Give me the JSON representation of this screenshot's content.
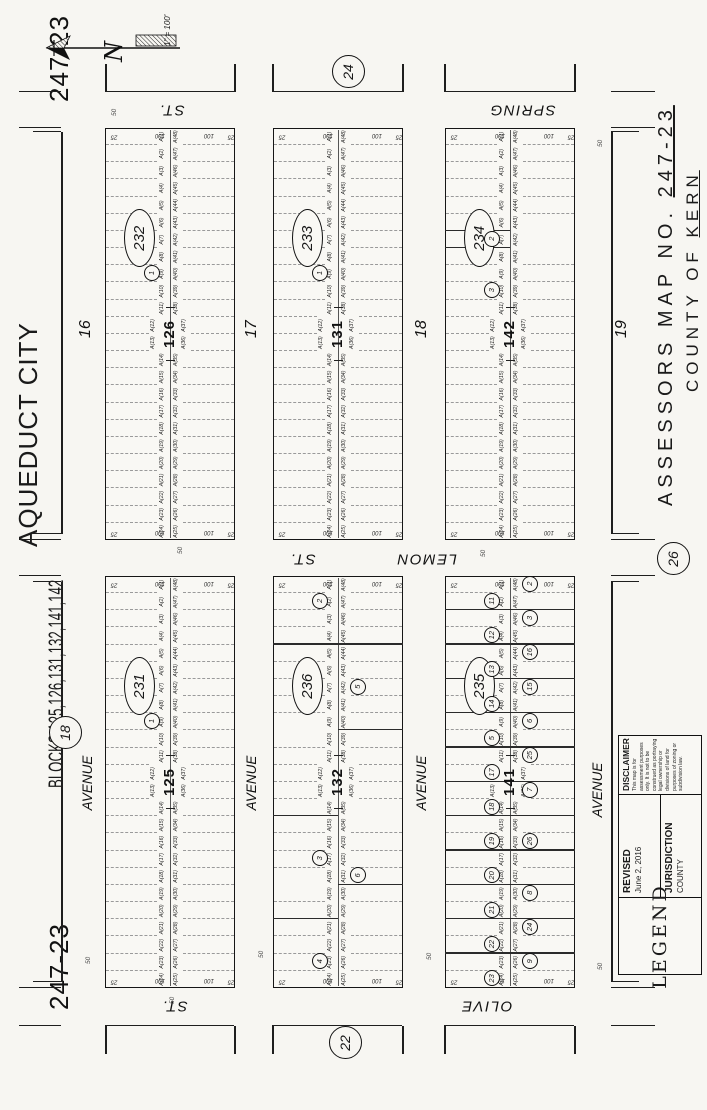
{
  "page": {
    "sheet_no": "247-23",
    "title_line1": "AQUEDUCT CITY",
    "title_line2": "BLOCKS 125,126,131,132,141,142",
    "assessors_prefix": "ASSESSORS MAP NO.",
    "assessors_no": "247-23",
    "county_prefix": "COUNTY OF",
    "county_name": "KERN",
    "scale_label": "1\" = 100'",
    "north_label": "N"
  },
  "legend": {
    "legend_word": "LEGEND",
    "revised_label": "REVISED",
    "revised_date": "June 2, 2016",
    "jurisdiction_label": "JURISDICTION",
    "jurisdiction_value": "COUNTY",
    "disclaimer_label": "DISCLAIMER",
    "disclaimer_text": "This map is for assessment purposes only. It is not to be construed as portraying legal ownership or divisions of land for purposes of zoning or subdivision law."
  },
  "adjacent_sheets": [
    {
      "label": "24",
      "x": 1037,
      "y": 347
    },
    {
      "label": "18",
      "x": 376,
      "y": 64
    },
    {
      "label": "26",
      "x": 550,
      "y": 672
    },
    {
      "label": "22",
      "x": 66,
      "y": 344
    }
  ],
  "streets": {
    "avenue_label": "AVENUE",
    "avenues": [
      {
        "number": "16",
        "label_x": 327,
        "label_y": 88,
        "num_x": 772,
        "num_y": 86
      },
      {
        "number": "17",
        "label_x": 327,
        "label_y": 252,
        "num_x": 772,
        "num_y": 252
      },
      {
        "number": "18",
        "label_x": 327,
        "label_y": 422,
        "num_x": 772,
        "num_y": 422
      },
      {
        "number": "19",
        "label_x": 320,
        "label_y": 598,
        "num_x": 772,
        "num_y": 622
      }
    ],
    "cross_streets": [
      {
        "name": "OLIVE",
        "suffix": "ST.",
        "x": 104,
        "name_y": 487,
        "suffix_y": 175
      },
      {
        "name": "LEMON",
        "suffix": "ST.",
        "x": 551,
        "name_y": 427,
        "suffix_y": 303
      },
      {
        "name": "SPRING",
        "suffix": "ST.",
        "x": 1000,
        "name_y": 523,
        "suffix_y": 172
      }
    ],
    "width_labels": [
      {
        "t": "50",
        "x": 994,
        "y": 112
      },
      {
        "t": "50",
        "x": 556,
        "y": 178
      },
      {
        "t": "50",
        "x": 553,
        "y": 481
      },
      {
        "t": "50",
        "x": 106,
        "y": 170
      },
      {
        "t": "50",
        "x": 146,
        "y": 86
      },
      {
        "t": "50",
        "x": 152,
        "y": 259
      },
      {
        "t": "50",
        "x": 150,
        "y": 427
      },
      {
        "t": "50",
        "x": 140,
        "y": 598
      },
      {
        "t": "50",
        "x": 963,
        "y": 598
      }
    ]
  },
  "lots": [
    "A(1)",
    "A(2)",
    "A(3)",
    "A(4)",
    "A(5)",
    "A(6)",
    "A(7)",
    "A(8)",
    "A(9)",
    "A(10)",
    "A(11)",
    "A(12)",
    "A(13)",
    "A(14)",
    "A(15)",
    "A(16)",
    "A(17)",
    "A(18)",
    "A(19)",
    "A(20)",
    "A(21)",
    "A(22)",
    "A(23)",
    "A(24)",
    "A(25)",
    "A(26)",
    "A(27)",
    "A(28)",
    "A(29)",
    "A(30)",
    "A(31)",
    "A(32)",
    "A(33)",
    "A(34)",
    "A(35)",
    "A(36)",
    "A(37)",
    "A(38)",
    "A(39)",
    "A(40)",
    "A(41)",
    "A(42)",
    "A(43)",
    "A(44)",
    "A(45)",
    "A(46)",
    "A(47)",
    "A(48)"
  ],
  "edge_dims": [
    "25",
    "100",
    "100",
    "25"
  ],
  "blocks": [
    {
      "id": "232",
      "number": "126",
      "x": 570,
      "y": 105,
      "parcels": [
        {
          "n": "1",
          "c": 9,
          "half": "top"
        }
      ],
      "solids": []
    },
    {
      "id": "233",
      "number": "131",
      "x": 570,
      "y": 273,
      "parcels": [
        {
          "n": "1",
          "c": 9,
          "half": "top"
        }
      ],
      "solids": []
    },
    {
      "id": "234",
      "number": "142",
      "x": 570,
      "y": 445,
      "parcels": [
        {
          "n": "2",
          "c": 7,
          "half": "top"
        },
        {
          "n": "3",
          "c": 10,
          "half": "top"
        }
      ],
      "solids": [
        {
          "b": 6,
          "half": "top"
        },
        {
          "b": 7,
          "half": "top"
        }
      ]
    },
    {
      "id": "231",
      "number": "125",
      "x": 122,
      "y": 105,
      "parcels": [
        {
          "n": "1",
          "c": 9,
          "half": "top"
        }
      ],
      "solids": []
    },
    {
      "id": "236",
      "number": "132",
      "x": 122,
      "y": 273,
      "parcels": [
        {
          "n": "2",
          "c": 2,
          "half": "top"
        },
        {
          "n": "3",
          "c": 17,
          "half": "top"
        },
        {
          "n": "4",
          "c": 23,
          "half": "top"
        },
        {
          "n": "5",
          "c": 7,
          "half": "bottom"
        },
        {
          "n": "6",
          "c": 18,
          "half": "bottom"
        }
      ],
      "solids": [
        {
          "b": 4,
          "half": "full"
        },
        {
          "b": 9,
          "half": "bottom"
        },
        {
          "b": 14,
          "half": "top"
        },
        {
          "b": 18,
          "half": "bottom"
        },
        {
          "b": 20,
          "half": "top"
        }
      ]
    },
    {
      "id": "235",
      "number": "141",
      "x": 122,
      "y": 445,
      "parcels": [
        {
          "n": "11",
          "c": 2,
          "half": "top"
        },
        {
          "n": "12",
          "c": 4,
          "half": "top"
        },
        {
          "n": "13",
          "c": 6,
          "half": "top"
        },
        {
          "n": "14",
          "c": 8,
          "half": "top"
        },
        {
          "n": "5",
          "c": 10,
          "half": "top"
        },
        {
          "n": "17",
          "c": 12,
          "half": "top"
        },
        {
          "n": "18",
          "c": 14,
          "half": "top"
        },
        {
          "n": "19",
          "c": 16,
          "half": "top"
        },
        {
          "n": "20",
          "c": 18,
          "half": "top"
        },
        {
          "n": "21",
          "c": 20,
          "half": "top"
        },
        {
          "n": "22",
          "c": 22,
          "half": "top"
        },
        {
          "n": "23",
          "c": 24,
          "half": "top"
        },
        {
          "n": "2",
          "c": 1,
          "half": "bottom"
        },
        {
          "n": "3",
          "c": 3,
          "half": "bottom"
        },
        {
          "n": "16",
          "c": 5,
          "half": "bottom"
        },
        {
          "n": "15",
          "c": 7,
          "half": "bottom"
        },
        {
          "n": "6",
          "c": 9,
          "half": "bottom"
        },
        {
          "n": "25",
          "c": 11,
          "half": "bottom"
        },
        {
          "n": "7",
          "c": 13,
          "half": "bottom"
        },
        {
          "n": "26",
          "c": 16,
          "half": "bottom"
        },
        {
          "n": "8",
          "c": 19,
          "half": "bottom"
        },
        {
          "n": "24",
          "c": 21,
          "half": "bottom"
        },
        {
          "n": "9",
          "c": 23,
          "half": "bottom"
        }
      ],
      "solids": [
        {
          "b": 2,
          "half": "full"
        },
        {
          "b": 4,
          "half": "full"
        },
        {
          "b": 6,
          "half": "full"
        },
        {
          "b": 8,
          "half": "full"
        },
        {
          "b": 10,
          "half": "full"
        },
        {
          "b": 12,
          "half": "full"
        },
        {
          "b": 14,
          "half": "full"
        },
        {
          "b": 16,
          "half": "full"
        },
        {
          "b": 18,
          "half": "full"
        },
        {
          "b": 20,
          "half": "full"
        },
        {
          "b": 22,
          "half": "full"
        }
      ]
    }
  ],
  "frame_segments": [
    [
      84,
      106,
      84,
      235
    ],
    [
      56,
      106,
      84,
      106
    ],
    [
      56,
      235,
      84,
      235
    ],
    [
      84,
      273,
      84,
      403
    ],
    [
      56,
      273,
      84,
      273
    ],
    [
      56,
      403,
      84,
      403
    ],
    [
      84,
      445,
      84,
      575
    ],
    [
      56,
      445,
      84,
      445
    ],
    [
      56,
      575,
      84,
      575
    ],
    [
      1018,
      106,
      1018,
      235
    ],
    [
      1018,
      106,
      1046,
      106
    ],
    [
      1018,
      235,
      1046,
      235
    ],
    [
      1018,
      273,
      1018,
      403
    ],
    [
      1018,
      273,
      1046,
      273
    ],
    [
      1018,
      403,
      1046,
      403
    ],
    [
      1018,
      445,
      1018,
      575
    ],
    [
      1018,
      445,
      1046,
      445
    ],
    [
      1018,
      575,
      1046,
      575
    ],
    [
      128,
      62,
      528,
      62
    ],
    [
      128,
      34,
      128,
      62
    ],
    [
      528,
      34,
      528,
      62
    ],
    [
      576,
      62,
      978,
      62
    ],
    [
      576,
      34,
      576,
      62
    ],
    [
      978,
      34,
      978,
      62
    ],
    [
      128,
      612,
      528,
      612
    ],
    [
      128,
      612,
      128,
      640
    ],
    [
      528,
      612,
      528,
      640
    ],
    [
      576,
      612,
      978,
      612
    ],
    [
      576,
      612,
      576,
      640
    ],
    [
      978,
      612,
      978,
      640
    ],
    [
      534,
      20,
      534,
      62
    ],
    [
      570,
      20,
      570,
      62
    ],
    [
      534,
      612,
      534,
      656
    ],
    [
      570,
      612,
      570,
      656
    ],
    [
      84,
      20,
      84,
      62
    ],
    [
      122,
      20,
      122,
      62
    ],
    [
      84,
      612,
      84,
      656
    ],
    [
      122,
      612,
      122,
      656
    ],
    [
      982,
      20,
      982,
      62
    ],
    [
      1018,
      20,
      1018,
      62
    ],
    [
      982,
      612,
      982,
      656
    ],
    [
      1018,
      612,
      1018,
      656
    ]
  ]
}
